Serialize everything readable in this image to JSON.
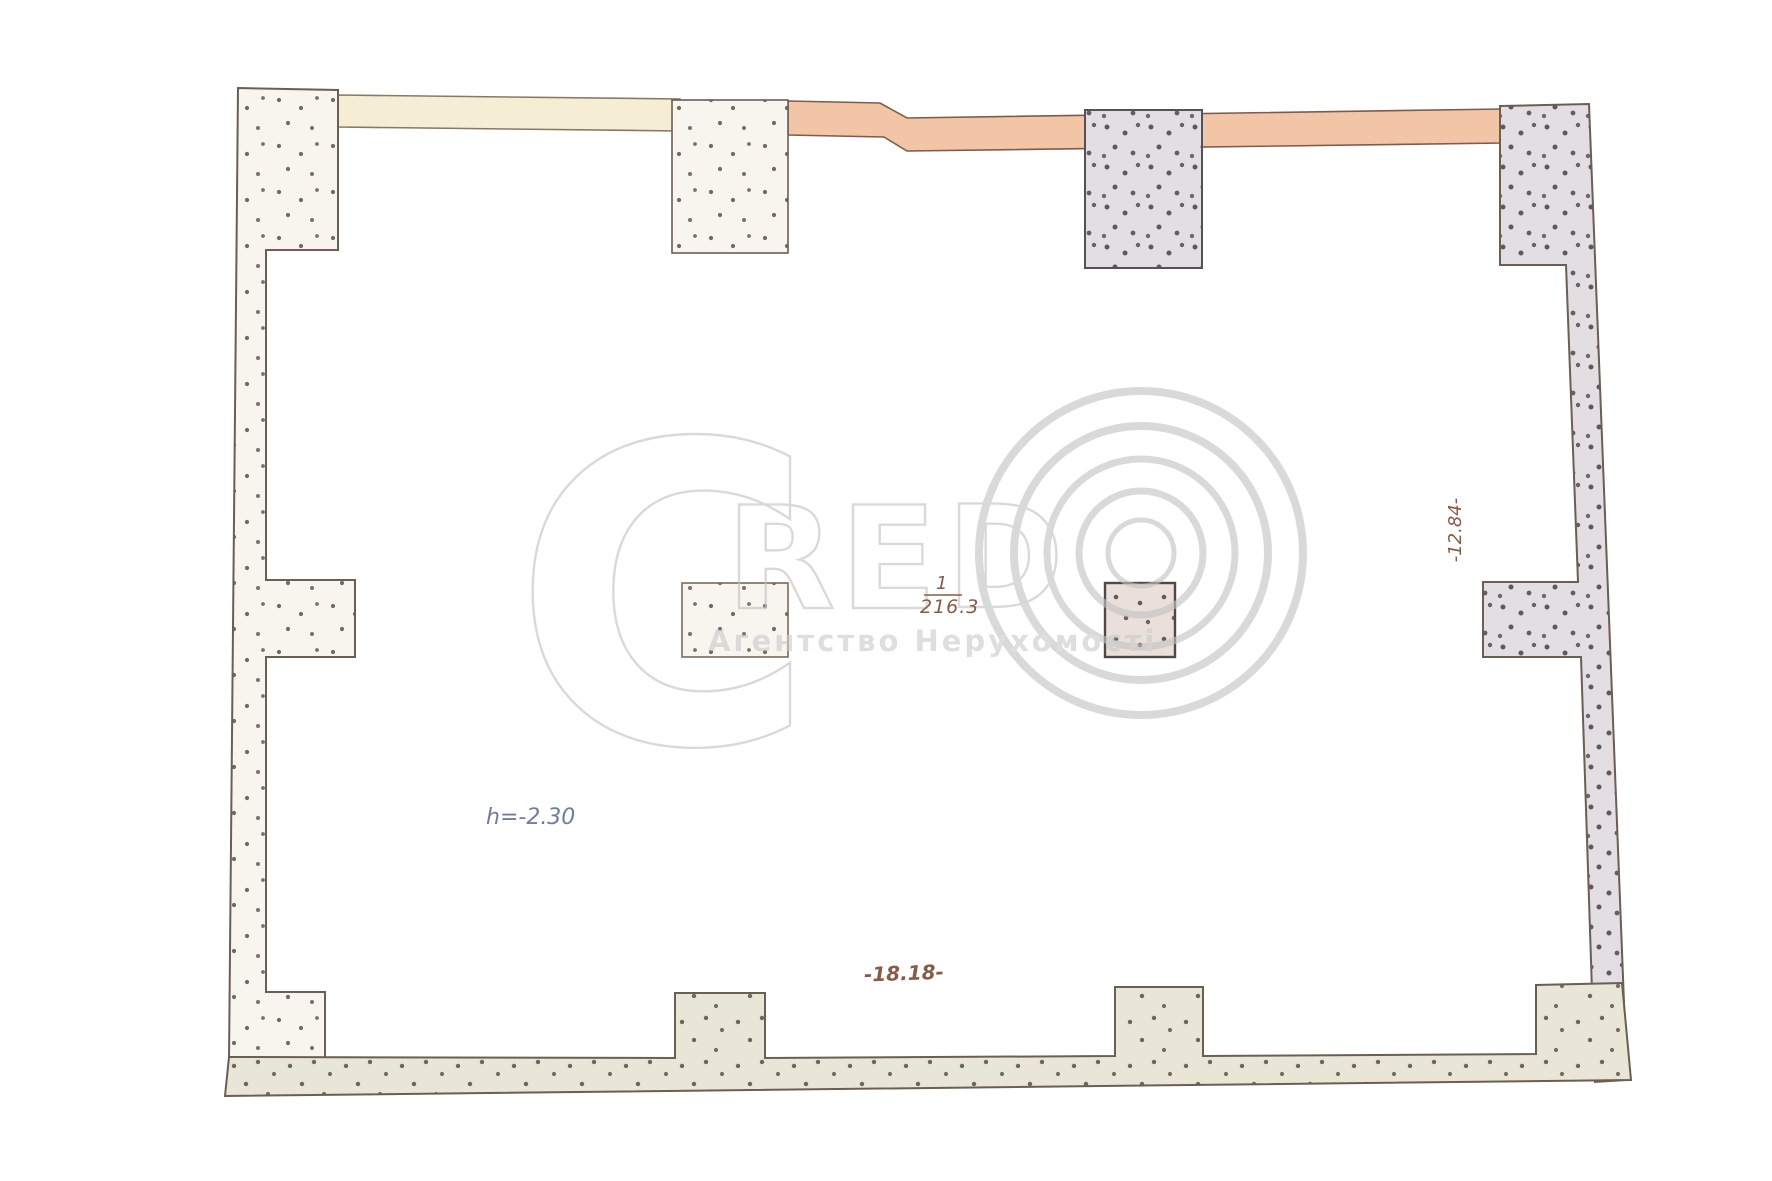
{
  "document": {
    "kind": "apartment floor plan scan",
    "room": {
      "number": "1",
      "area": "216.3"
    },
    "ceiling_height_label": "h=-2.30",
    "width_dimension": "-18.18-",
    "height_dimension": "-12.84-"
  },
  "watermark": {
    "letter_c": "C",
    "letter_r": "R",
    "letter_e": "E",
    "letter_d": "D",
    "agency_line": "Агентство Нерухомості"
  },
  "colors": {
    "band_cream": "#f6eed4",
    "band_pink": "#f3c5a7",
    "wall_outline": "#6b5e52",
    "stipple_dot": "#59504a",
    "annotation_brown": "#8a5a44",
    "annotation_blue": "#707ba3",
    "watermark_gray": "#c3c3c3",
    "background": "#ffffff"
  }
}
